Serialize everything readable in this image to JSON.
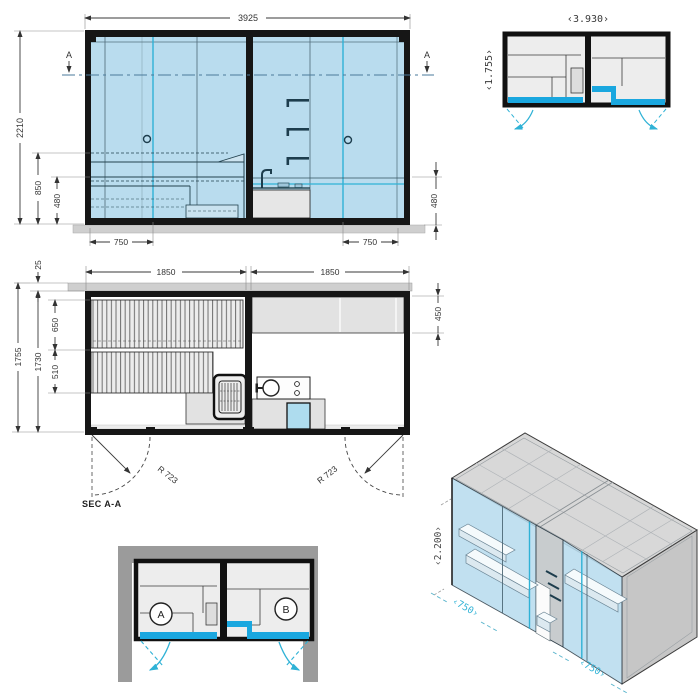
{
  "colors": {
    "glass": "#b9dcee",
    "glasslight": "#cde4f0",
    "accent": "#1aa7df",
    "teal": "#2fb2d6",
    "wallgray": "#9b9b9b",
    "furn": "#e2e2e2",
    "roof": "#d8d8d8",
    "sectionline": "#4a7a9b",
    "ink": "#161616"
  },
  "elevation": {
    "dim_width": "3925",
    "dim_total_height": "2210",
    "dim_counter_height": "850",
    "dim_bench_height_left": "480",
    "dim_bench_height_right": "480",
    "dim_door_left": "750",
    "dim_door_right": "750",
    "section_marker_left": "A",
    "section_marker_right": "A"
  },
  "plan_mini_top": {
    "dim_width": "‹3.930›",
    "dim_depth": "‹1.755›"
  },
  "section_plan": {
    "label": "SEC A-A",
    "dim_room_left": "1850",
    "dim_room_right": "1850",
    "dim_wall": "25",
    "dim_depth_total": "1755",
    "dim_depth_inner": "1730",
    "dim_bench_upper": "650",
    "dim_bench_lower": "510",
    "dim_counter_depth": "450",
    "door_swing_left": "R 723",
    "door_swing_right": "R 723"
  },
  "plan_mini_bottom": {
    "room_a_label": "A",
    "room_b_label": "B"
  },
  "isometric": {
    "dim_height": "‹2.200›",
    "dim_left": "‹750›",
    "dim_right": "‹750›"
  }
}
